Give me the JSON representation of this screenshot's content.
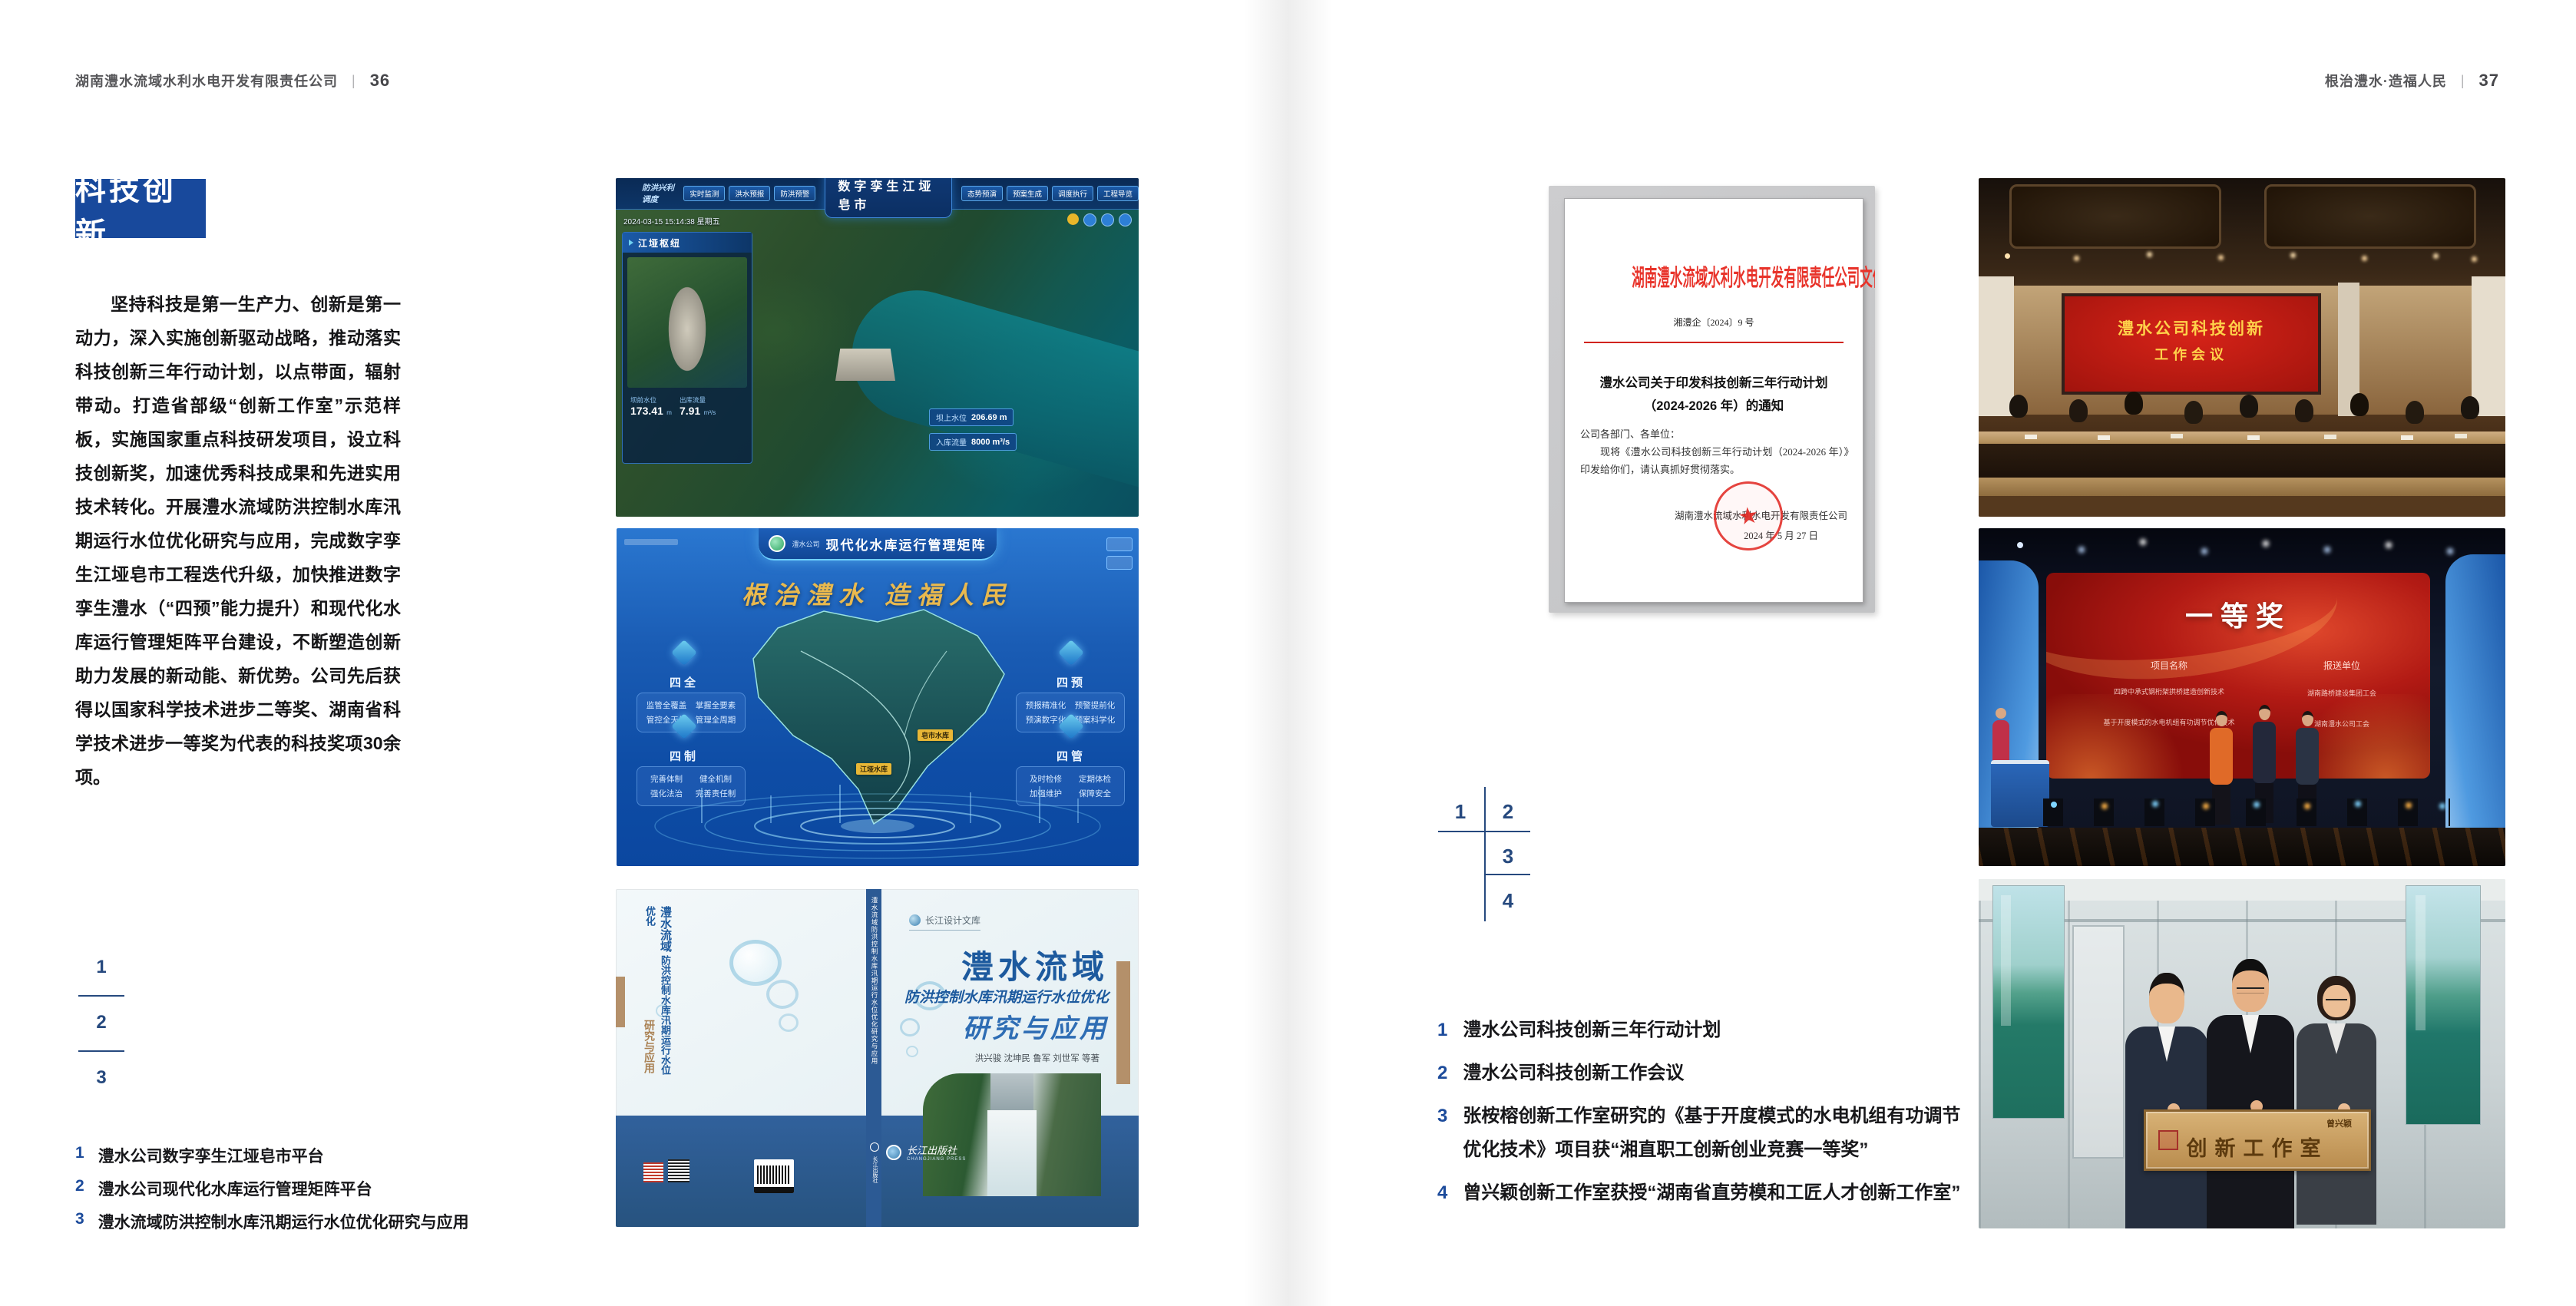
{
  "page_left": {
    "header": {
      "company": "湖南澧水流域水利水电开发有限责任公司",
      "divider": "|",
      "page_number": "36"
    },
    "badge": "科技创新",
    "paragraph": "坚持科技是第一生产力、创新是第一动力，深入实施创新驱动战略，推动落实科技创新三年行动计划，以点带面，辐射带动。打造省部级“创新工作室”示范样板，实施国家重点科技研发项目，设立科技创新奖，加速优秀科技成果和先进实用技术转化。开展澧水流域防洪控制水库汛期运行水位优化研究与应用，完成数字孪生江垭皂市工程迭代升级，加快推进数字孪生澧水（“四预”能力提升）和现代化水库运行管理矩阵平台建设，不断塑造创新助力发展的新动能、新优势。公司先后获得以国家科学技术进步二等奖、湖南省科学技术进步一等奖为代表的科技奖项30余项。",
    "figure_index": [
      "1",
      "2",
      "3"
    ],
    "captions": [
      {
        "num": "1",
        "text": "澧水公司数字孪生江垭皂市平台"
      },
      {
        "num": "2",
        "text": "澧水公司现代化水库运行管理矩阵平台"
      },
      {
        "num": "3",
        "text": "澧水流域防洪控制水库汛期运行水位优化研究与应用"
      }
    ]
  },
  "page_right": {
    "header": {
      "slogan": "根治澧水·造福人民",
      "divider": "|",
      "page_number": "37"
    },
    "figure_index": [
      "1",
      "2",
      "3",
      "4"
    ],
    "captions": [
      {
        "num": "1",
        "text": "澧水公司科技创新三年行动计划"
      },
      {
        "num": "2",
        "text": "澧水公司科技创新工作会议"
      },
      {
        "num": "3",
        "text": "张桉榕创新工作室研究的《基于开度模式的水电机组有功调节优化技术》项目获“湘直职工创新创业竞赛一等奖”"
      },
      {
        "num": "4",
        "text": "曾兴颖创新工作室获授“湖南省直劳模和工匠人才创新工作室”"
      }
    ]
  },
  "fig_dashboard": {
    "title": "数字孪生江垭皂市",
    "left_group": "防洪兴利调度",
    "tabs_left": [
      "实时监测",
      "洪水预报",
      "防洪预警"
    ],
    "tabs_right": [
      "态势预演",
      "预案生成",
      "调度执行",
      "工程导览"
    ],
    "timestamp": "2024-03-15 15:14:38 星期五",
    "panel_title": "江垭枢纽",
    "stats": [
      {
        "label": "坝前水位",
        "value": "173.41",
        "unit": "m"
      },
      {
        "label": "出库流量",
        "value": "7.91",
        "unit": "m³/s"
      }
    ],
    "callouts": [
      {
        "label": "坝上水位",
        "value": "206.69 m"
      },
      {
        "label": "入库流量",
        "value": "8000 m³/s"
      }
    ]
  },
  "fig_matrix": {
    "brand": "澧水公司",
    "title": "现代化水库运行管理矩阵",
    "slogan": "根治澧水 造福人民",
    "map_labels": [
      "皂市水库",
      "江垭水库"
    ],
    "corners": [
      {
        "label": "四全",
        "items": [
          "监管全覆盖",
          "掌握全要素",
          "管控全天候",
          "管理全周期"
        ]
      },
      {
        "label": "四预",
        "items": [
          "预报精准化",
          "预警提前化",
          "预演数字化",
          "预案科学化"
        ]
      },
      {
        "label": "四制",
        "items": [
          "完善体制",
          "健全机制",
          "强化法治",
          "完善责任制"
        ]
      },
      {
        "label": "四管",
        "items": [
          "及时检修",
          "定期体检",
          "加强维护",
          "保障安全"
        ]
      }
    ]
  },
  "fig_book": {
    "series": "长江设计文库",
    "title": "澧水流域",
    "subtitle": "防洪控制水库汛期运行水位优化",
    "tail": "研究与应用",
    "authors": "洪兴骏 沈坤民 鲁军 刘世军 等著",
    "publisher": "长江出版社",
    "publisher_en": "CHANGJIANG PRESS",
    "spine_title": "澧水流域防洪控制水库汛期运行水位优化研究与应用"
  },
  "fig_document": {
    "header": "湖南澧水流域水利水电开发有限责任公司文件",
    "doc_number": "湘澧企〔2024〕9 号",
    "title_line1": "澧水公司关于印发科技创新三年行动计划",
    "title_line2": "（2024-2026 年）的通知",
    "salutation": "公司各部门、各单位：",
    "body": "现将《澧水公司科技创新三年行动计划（2024-2026 年）》印发给你们，请认真抓好贯彻落实。",
    "signer": "湖南澧水流域水利水电开发有限责任公司",
    "date": "2024 年 5 月 27 日"
  },
  "photo_meeting": {
    "screen_line1": "澧水公司科技创新",
    "screen_line2": "工作会议"
  },
  "photo_award": {
    "screen_title": "一等奖",
    "col_project": "项目名称",
    "col_unit": "报送单位",
    "projects": [
      "四跨中承式钢桁架拱桥建造创新技术",
      "基于开度模式的水电机组有功调节优化技术"
    ],
    "units": [
      "湖南路桥建设集团工会",
      "湖南澧水公司工会"
    ]
  },
  "photo_plaque": {
    "owner": "曾兴颖",
    "plaque": "创新工作室"
  }
}
